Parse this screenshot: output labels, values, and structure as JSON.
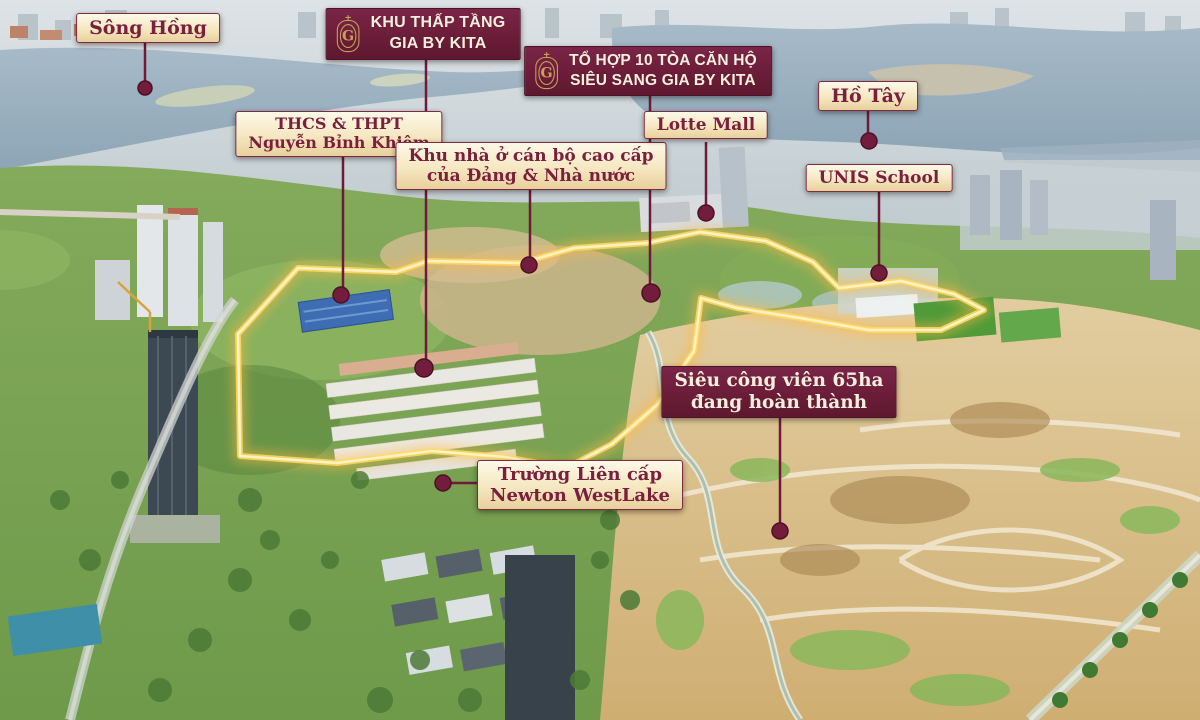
{
  "annotations": {
    "song_hong": {
      "text": "Sông Hồng"
    },
    "khu_thap_tang": {
      "line1": "KHU THẤP TẦNG",
      "line2": "GIA BY KITA"
    },
    "to_hop": {
      "line1": "TỔ HỢP 10 TÒA CĂN HỘ",
      "line2": "SIÊU SANG GIA BY KITA"
    },
    "ho_tay": {
      "text": "Hồ Tây"
    },
    "thcs": {
      "line1": "THCS & THPT",
      "line2": "Nguyễn Bỉnh Khiêm"
    },
    "khu_nha_o": {
      "line1": "Khu nhà ở cán bộ cao cấp",
      "line2": "của Đảng & Nhà nước"
    },
    "lotte_mall": {
      "text": "Lotte Mall"
    },
    "unis_school": {
      "text": "UNIS School"
    },
    "sieu_cong_vien": {
      "line1": "Siêu công viên 65ha",
      "line2": "đang hoàn thành"
    },
    "newton": {
      "line1": "Trường Liên cấp",
      "line2": "Newton WestLake"
    }
  },
  "branding": {
    "monogram": "G",
    "emblem_icon": "kita-monogram-emblem"
  },
  "colors": {
    "label_maroon_bg": "#6b1d38",
    "label_cream_bg": "#f5e7c0",
    "label_text_maroon": "#7a1f3d",
    "label_text_cream": "#f6efdd",
    "emblem_gold": "#c9a05a",
    "leader_line": "#6e1b38",
    "boundary_glow": "#ffd966"
  }
}
